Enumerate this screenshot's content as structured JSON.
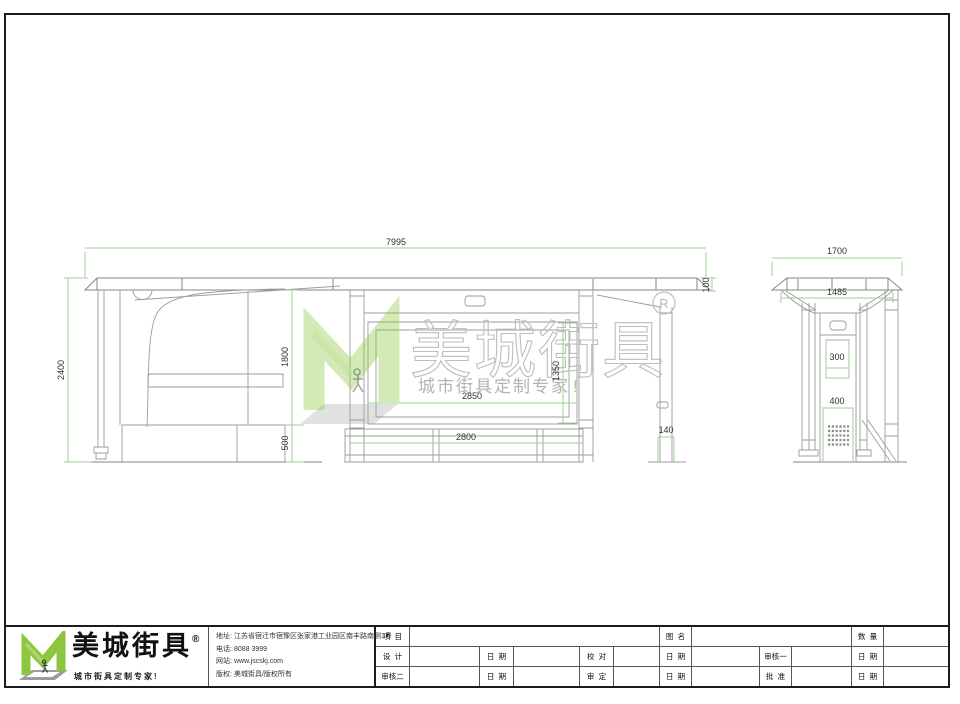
{
  "colors": {
    "line": "#9c9c9c",
    "dim_line": "#9ccf94",
    "dim_text": "#333333",
    "brand_green": "#8cc63e",
    "watermark_gray": "#bdbdbd"
  },
  "drawing": {
    "front_view": {
      "dims": {
        "total_width": "7995",
        "total_height": "2400",
        "clear_height": "1800",
        "base_height": "500",
        "lightbox_width": "2850",
        "lightbox_height": "1350",
        "bench_width": "2800",
        "post_width": "140",
        "roof_thickness": "100"
      }
    },
    "side_view": {
      "dims": {
        "roof_width": "1700",
        "body_width": "1485",
        "upper_panel_width": "300",
        "lower_panel_width": "400"
      }
    }
  },
  "watermark": {
    "brand": "美城街具",
    "tagline": "城市街具定制专家",
    "exclamation": "!",
    "registered_letter": "R"
  },
  "brand_block": {
    "name": "美城街具",
    "registered": "®",
    "tagline": "城市街具定制专家!"
  },
  "company_info": {
    "lines": [
      {
        "label": "地址:",
        "value": "江苏省宿迁市宿豫区张家港工业园区南丰路南侧1号"
      },
      {
        "label": "电话:",
        "value": "8088 3999"
      },
      {
        "label": "网站:",
        "value": "www.jscskj.com"
      },
      {
        "label": "版权:",
        "value": "美城街具/版权所有"
      }
    ]
  },
  "title_table": {
    "project_label": "项  目",
    "drawing_name_label": "图  名",
    "quantity_label": "数  量",
    "design_label": "设  计",
    "proofread_label": "校  对",
    "reviewer1_label": "审核一",
    "reviewer2_label": "审核二",
    "approval_label": "审  定",
    "approve_label": "批  准",
    "date_label": "日  期"
  }
}
